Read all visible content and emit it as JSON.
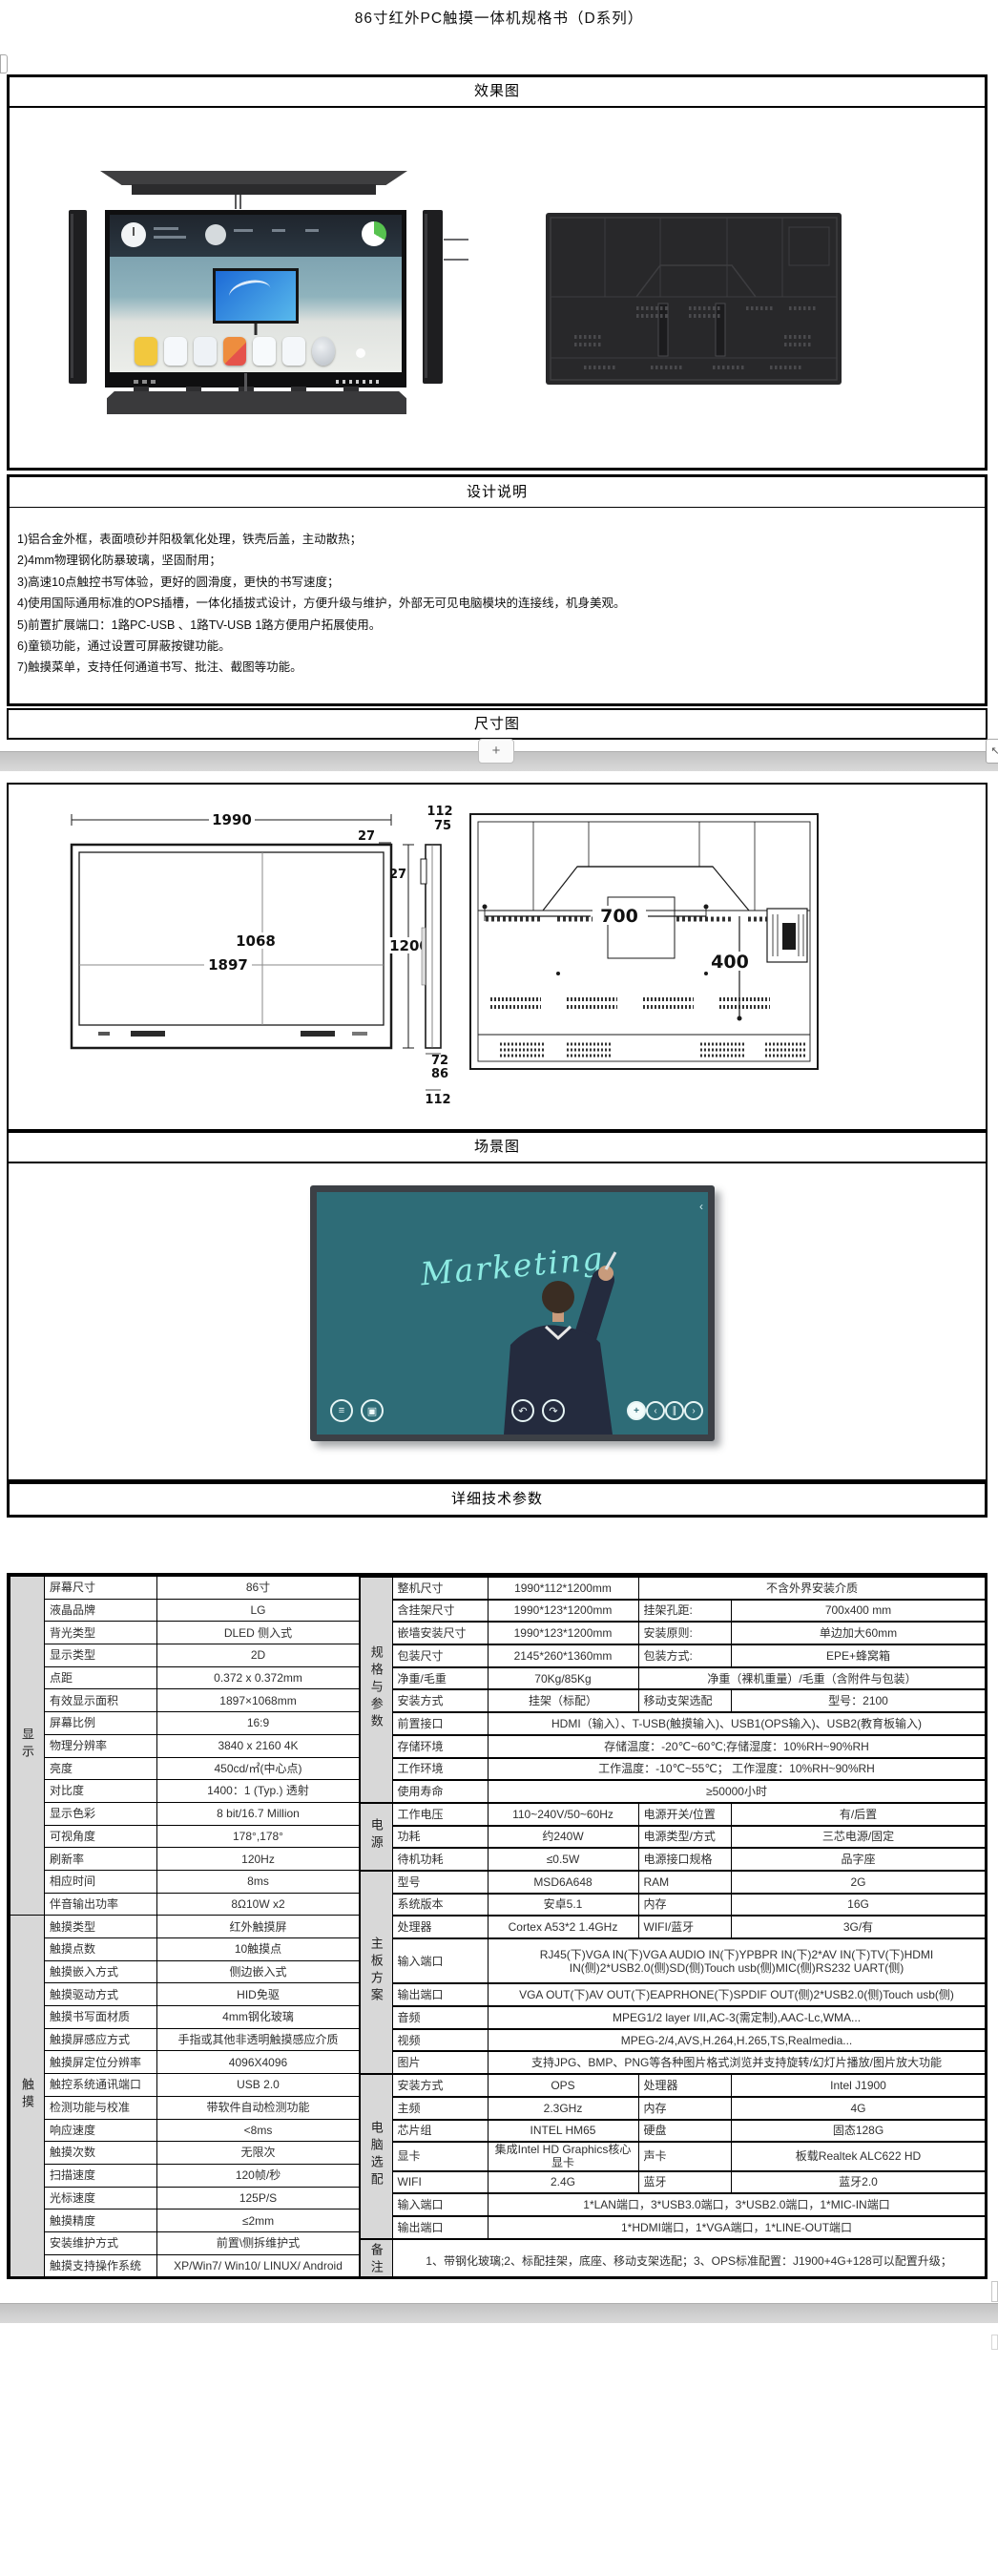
{
  "title": "86寸红外PC触摸一体机规格书（D系列）",
  "sections": {
    "effect": "效果图",
    "design": "设计说明",
    "dimension": "尺寸图",
    "scene": "场景图",
    "specs": "详细技术参数"
  },
  "design_notes": [
    "1)铝合金外框，表面喷砂并阳极氧化处理，铁壳后盖，主动散热；",
    "2)4mm物理钢化防暴玻璃，坚固耐用；",
    "3)高速10点触控书写体验，更好的圆滑度，更快的书写速度；",
    "4)使用国际通用标准的OPS插槽，一体化插拔式设计，方便升级与维护，外部无可见电脑模块的连接线，机身美观。",
    "5)前置扩展端口：1路PC-USB 、1路TV-USB 1路方便用户拓展使用。",
    "6)童锁功能，通过设置可屏蔽按键功能。",
    "7)触摸菜单，支持任何通道书写、批注、截图等功能。"
  ],
  "page_widgets": {
    "insert_plus": "+",
    "expand_arrow": "↖"
  },
  "dim": {
    "front_w": "1990",
    "bezel_top": "27",
    "bezel_right": "27",
    "height": "1200",
    "active_h": "1068",
    "active_w": "1897",
    "side_top1": "112",
    "side_top2": "75",
    "side_bot1": "72",
    "side_bot2": "86",
    "side_bot3": "112",
    "vesa_w": "700",
    "vesa_h": "400"
  },
  "scene": {
    "handwriting": "Marketing",
    "chevron": "‹",
    "toolbar": [
      {
        "name": "menu-icon",
        "glyph": "≡"
      },
      {
        "name": "image-icon",
        "glyph": "▣"
      },
      {
        "name": "undo-icon",
        "glyph": "↶"
      },
      {
        "name": "redo-icon",
        "glyph": "↷"
      },
      {
        "name": "add-icon",
        "glyph": "+"
      },
      {
        "name": "prev-icon",
        "glyph": "‹"
      },
      {
        "name": "pause-icon",
        "glyph": "∥"
      },
      {
        "name": "next-icon",
        "glyph": "›"
      }
    ]
  },
  "colors": {
    "group_bg": "#d8d8d8",
    "screen_teal": "#2e6c77",
    "writing_cyan": "#8debe3",
    "border": "#000000"
  },
  "spec_table": {
    "left_groups": [
      {
        "label": "显示",
        "rows": [
          [
            "屏幕尺寸",
            "86寸"
          ],
          [
            "液晶品牌",
            "LG"
          ],
          [
            "背光类型",
            "DLED 侧入式"
          ],
          [
            "显示类型",
            "2D"
          ],
          [
            "点距",
            "0.372 x 0.372mm"
          ],
          [
            "有效显示面积",
            "1897×1068mm"
          ],
          [
            "屏幕比例",
            "16:9"
          ],
          [
            "物理分辨率",
            "3840 x 2160  4K"
          ],
          [
            "亮度",
            "450cd/㎡(中心点)"
          ],
          [
            "对比度",
            "1400：1 (Typ.) 透射"
          ],
          [
            "显示色彩",
            "8 bit/16.7 Million"
          ],
          [
            "可视角度",
            "178°,178°"
          ],
          [
            "刷新率",
            "120Hz"
          ],
          [
            "相应时间",
            "8ms"
          ],
          [
            "伴音输出功率",
            "8Ω10W  x2"
          ]
        ]
      },
      {
        "label": "触摸",
        "rows": [
          [
            "触摸类型",
            "红外触摸屏"
          ],
          [
            "触摸点数",
            "10触摸点"
          ],
          [
            "触摸嵌入方式",
            "侧边嵌入式"
          ],
          [
            "触摸驱动方式",
            "HID免驱"
          ],
          [
            "触摸书写面材质",
            "4mm钢化玻璃"
          ],
          [
            "触摸屏感应方式",
            "手指或其他非透明触摸感应介质"
          ],
          [
            "触摸屏定位分辨率",
            "4096X4096"
          ],
          [
            "触控系统通讯端口",
            "USB 2.0"
          ],
          [
            "检测功能与校准",
            "带软件自动检测功能"
          ],
          [
            "响应速度",
            "<8ms"
          ],
          [
            "触摸次数",
            "无限次"
          ],
          [
            "扫描速度",
            "120帧/秒"
          ],
          [
            "光标速度",
            "125P/S"
          ],
          [
            "触摸精度",
            "≤2mm"
          ],
          [
            "安装维护方式",
            "前置\\侧拆维护式"
          ],
          [
            "触摸支持操作系统",
            "XP/Win7/ Win10/ LINUX/ Android"
          ]
        ]
      }
    ],
    "right_groups": [
      {
        "label": "规格与参数",
        "rows": [
          {
            "cells": [
              "整机尺寸",
              "1990*112*1200mm",
              {
                "t": "不含外界安装介质",
                "span": 2
              }
            ]
          },
          {
            "cells": [
              "含挂架尺寸",
              "1990*123*1200mm",
              "挂架孔距:",
              "700x400 mm"
            ]
          },
          {
            "cells": [
              "嵌墙安装尺寸",
              "1990*123*1200mm",
              "安装原则:",
              "单边加大60mm"
            ]
          },
          {
            "cells": [
              "包装尺寸",
              "2145*260*1360mm",
              "包装方式:",
              "EPE+蜂窝箱"
            ]
          },
          {
            "cells": [
              "净重/毛重",
              "70Kg/85Kg",
              {
                "t": "净重（裸机重量）/毛重（含附件与包装）",
                "span": 2
              }
            ]
          },
          {
            "cells": [
              "安装方式",
              "挂架（标配）",
              "移动支架选配",
              "型号：2100"
            ]
          },
          {
            "cells": [
              "前置接口",
              {
                "t": "HDMI（输入）、T-USB(触摸输入)、USB1(OPS输入)、USB2(教育板输入)",
                "span": 3
              }
            ]
          },
          {
            "cells": [
              "存储环境",
              {
                "t": "存储温度：-20℃~60℃;存储湿度：10%RH~90%RH",
                "span": 3
              }
            ]
          },
          {
            "cells": [
              "工作环境",
              {
                "t": "工作温度：-10℃~55℃； 工作湿度：10%RH~90%RH",
                "span": 3
              }
            ]
          },
          {
            "cells": [
              "使用寿命",
              {
                "t": "≥50000小时",
                "span": 3
              }
            ]
          }
        ]
      },
      {
        "label": "电源",
        "rows": [
          {
            "cells": [
              "工作电压",
              "110~240V/50~60Hz",
              "电源开关/位置",
              "有/后置"
            ]
          },
          {
            "cells": [
              "功耗",
              "约240W",
              "电源类型/方式",
              "三芯电源/固定"
            ]
          },
          {
            "cells": [
              "待机功耗",
              "≤0.5W",
              "电源接口规格",
              "品字座"
            ]
          }
        ]
      },
      {
        "label": "主板方案",
        "rows": [
          {
            "cells": [
              "型号",
              "MSD6A648",
              "RAM",
              "2G"
            ]
          },
          {
            "cells": [
              "系统版本",
              "安卓5.1",
              "内存",
              "16G"
            ]
          },
          {
            "cells": [
              "处理器",
              "Cortex A53*2 1.4GHz",
              "WIFI/蓝牙",
              "3G/有"
            ]
          },
          {
            "cells": [
              "输入端口",
              {
                "t": "RJ45(下)VGA IN(下)VGA AUDIO IN(下)YPBPR IN(下)2*AV IN(下)TV(下)HDMI IN(侧)2*USB2.0(侧)SD(侧)Touch usb(侧)MIC(侧)RS232 UART(侧)",
                "span": 3
              }
            ],
            "tall": true
          },
          {
            "cells": [
              "输出端口",
              {
                "t": "VGA OUT(下)AV OUT(下)EAPRHONE(下)SPDIF OUT(侧)2*USB2.0(侧)Touch usb(侧)",
                "span": 3
              }
            ]
          },
          {
            "cells": [
              "音频",
              {
                "t": "MPEG1/2 layer I/II,AC-3(需定制),AAC-Lc,WMA...",
                "span": 3
              }
            ]
          },
          {
            "cells": [
              "视频",
              {
                "t": "MPEG-2/4,AVS,H.264,H.265,TS,Realmedia...",
                "span": 3
              }
            ]
          },
          {
            "cells": [
              "图片",
              {
                "t": "支持JPG、BMP、PNG等各种图片格式浏览并支持旋转/幻灯片播放/图片放大功能",
                "span": 3
              }
            ]
          }
        ]
      },
      {
        "label": "电脑选配",
        "rows": [
          {
            "cells": [
              "安装方式",
              "OPS",
              "处理器",
              "Intel J1900"
            ]
          },
          {
            "cells": [
              "主频",
              "2.3GHz",
              "内存",
              "4G"
            ]
          },
          {
            "cells": [
              "芯片组",
              "INTEL HM65",
              "硬盘",
              "固态128G"
            ]
          },
          {
            "cells": [
              "显卡",
              "集成Intel HD Graphics核心显卡",
              "声卡",
              "板载Realtek ALC622 HD"
            ]
          },
          {
            "cells": [
              "WIFI",
              "2.4G",
              "蓝牙",
              "蓝牙2.0"
            ]
          },
          {
            "cells": [
              "输入端口",
              {
                "t": "1*LAN端口，3*USB3.0端口，3*USB2.0端口，1*MIC-IN端口",
                "span": 3
              }
            ]
          },
          {
            "cells": [
              "输出端口",
              {
                "t": "1*HDMI端口，1*VGA端口，1*LINE-OUT端口",
                "span": 3
              }
            ]
          }
        ]
      },
      {
        "label": "备注",
        "rows": [
          {
            "cells": [
              {
                "t": "1、带钢化玻璃;2、标配挂架，底座、移动支架选配；3、OPS标准配置：J1900+4G+128可以配置升级；",
                "span": 4
              }
            ],
            "tall": true
          }
        ]
      }
    ]
  }
}
